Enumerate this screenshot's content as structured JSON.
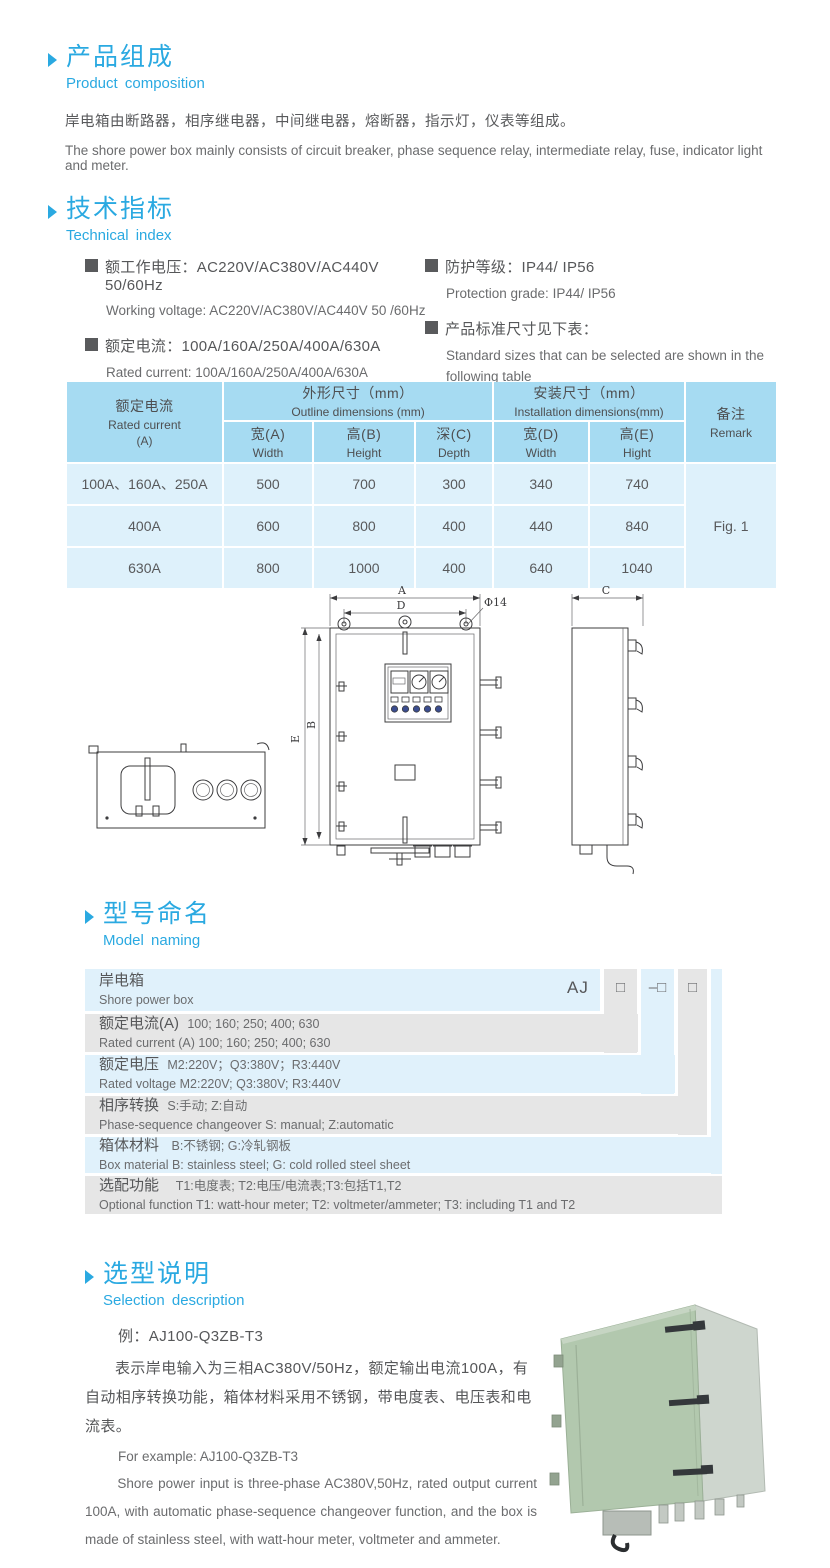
{
  "colors": {
    "accent_blue": "#2aa9e1",
    "body_text": "#595a5c",
    "table_header_bg": "#a6dbf2",
    "table_cell_bg": "#def1fb",
    "naming_row_blue": "#e0f1fb",
    "naming_row_gray": "#e6e6e6",
    "product_box_green": "#b2c8ae"
  },
  "composition": {
    "title_zh": "产品组成",
    "title_en": "Product composition",
    "body_zh": "岸电箱由断路器，相序继电器，中间继电器，熔断器，指示灯，仪表等组成。",
    "body_en": "The shore power box mainly consists of circuit breaker, phase sequence relay, intermediate relay, fuse, indicator light and meter."
  },
  "technical": {
    "title_zh": "技术指标",
    "title_en": "Technical index",
    "left": [
      {
        "zh": "额工作电压：AC220V/AC380V/AC440V  50/60Hz",
        "en": "Working voltage: AC220V/AC380V/AC440V 50 /60Hz"
      },
      {
        "zh": "额定电流：100A/160A/250A/400A/630A",
        "en": "Rated current: 100A/160A/250A/400A/630A"
      }
    ],
    "right": [
      {
        "zh": "防护等级：IP44/ IP56",
        "en": "Protection grade: IP44/ IP56"
      },
      {
        "zh": "产品标准尺寸见下表：",
        "en": "Standard sizes that can be selected are shown in the following table"
      }
    ]
  },
  "size_table": {
    "rated_zh": "额定电流",
    "rated_en": "Rated current",
    "rated_unit": "(A)",
    "outline_zh": "外形尺寸（mm）",
    "outline_en": "Outline dimensions (mm)",
    "install_zh": "安装尺寸（mm）",
    "install_en": "Installation dimensions(mm)",
    "remark_zh": "备注",
    "remark_en": "Remark",
    "sub": [
      {
        "zh": "宽(A)",
        "en": "Width"
      },
      {
        "zh": "高(B)",
        "en": "Height"
      },
      {
        "zh": "深(C)",
        "en": "Depth"
      },
      {
        "zh": "宽(D)",
        "en": "Width"
      },
      {
        "zh": "高(E)",
        "en": "Hight"
      }
    ],
    "rows": [
      {
        "current": "100A、160A、250A",
        "v": [
          "500",
          "700",
          "300",
          "340",
          "740"
        ]
      },
      {
        "current": "400A",
        "v": [
          "600",
          "800",
          "400",
          "440",
          "840"
        ]
      },
      {
        "current": "630A",
        "v": [
          "800",
          "1000",
          "400",
          "640",
          "1040"
        ]
      }
    ],
    "fig": "Fig. 1"
  },
  "drawing": {
    "a": "A",
    "d": "D",
    "phi": "Φ14",
    "e": "E",
    "b": "B",
    "c": "C"
  },
  "naming": {
    "title_zh": "型号命名",
    "title_en": "Model naming",
    "prefix": "AJ",
    "sym1": "□",
    "sym2": "–□",
    "sym3": "□",
    "rows": [
      {
        "zh_label": "岸电箱",
        "zh_text": "",
        "en": "Shore power box"
      },
      {
        "zh_label": "额定电流(A)",
        "zh_text": "100; 160; 250; 400; 630",
        "en": "Rated current (A) 100; 160; 250; 400; 630"
      },
      {
        "zh_label": "额定电压",
        "zh_text": "M2:220V；Q3:380V；R3:440V",
        "en": "Rated voltage  M2:220V;  Q3:380V;  R3:440V"
      },
      {
        "zh_label": "相序转换",
        "zh_text": "S:手动; Z:自动",
        "en": "Phase-sequence changeover  S: manual;  Z:automatic"
      },
      {
        "zh_label": "箱体材料",
        "zh_text": "B:不锈钢;  G:冷轧钢板",
        "en": "Box material    B: stainless steel; G: cold rolled steel sheet"
      },
      {
        "zh_label": "选配功能",
        "zh_text": "T1:电度表;  T2:电压/电流表;T3:包括T1,T2",
        "en": "Optional function  T1: watt-hour meter; T2: voltmeter/ammeter; T3: including T1 and T2"
      }
    ]
  },
  "selection": {
    "title_zh": "选型说明",
    "title_en": "Selection description",
    "example_zh": "例：AJ100-Q3ZB-T3",
    "body_zh": "表示岸电输入为三相AC380V/50Hz，额定输出电流100A，有自动相序转换功能，箱体材料采用不锈钢，带电度表、电压表和电流表。",
    "example_en": "For example: AJ100-Q3ZB-T3",
    "body_en": "Shore power input is three-phase AC380V,50Hz, rated output current 100A, with automatic phase-sequence changeover function, and the box is made of stainless steel, with watt-hour meter, voltmeter and ammeter."
  }
}
